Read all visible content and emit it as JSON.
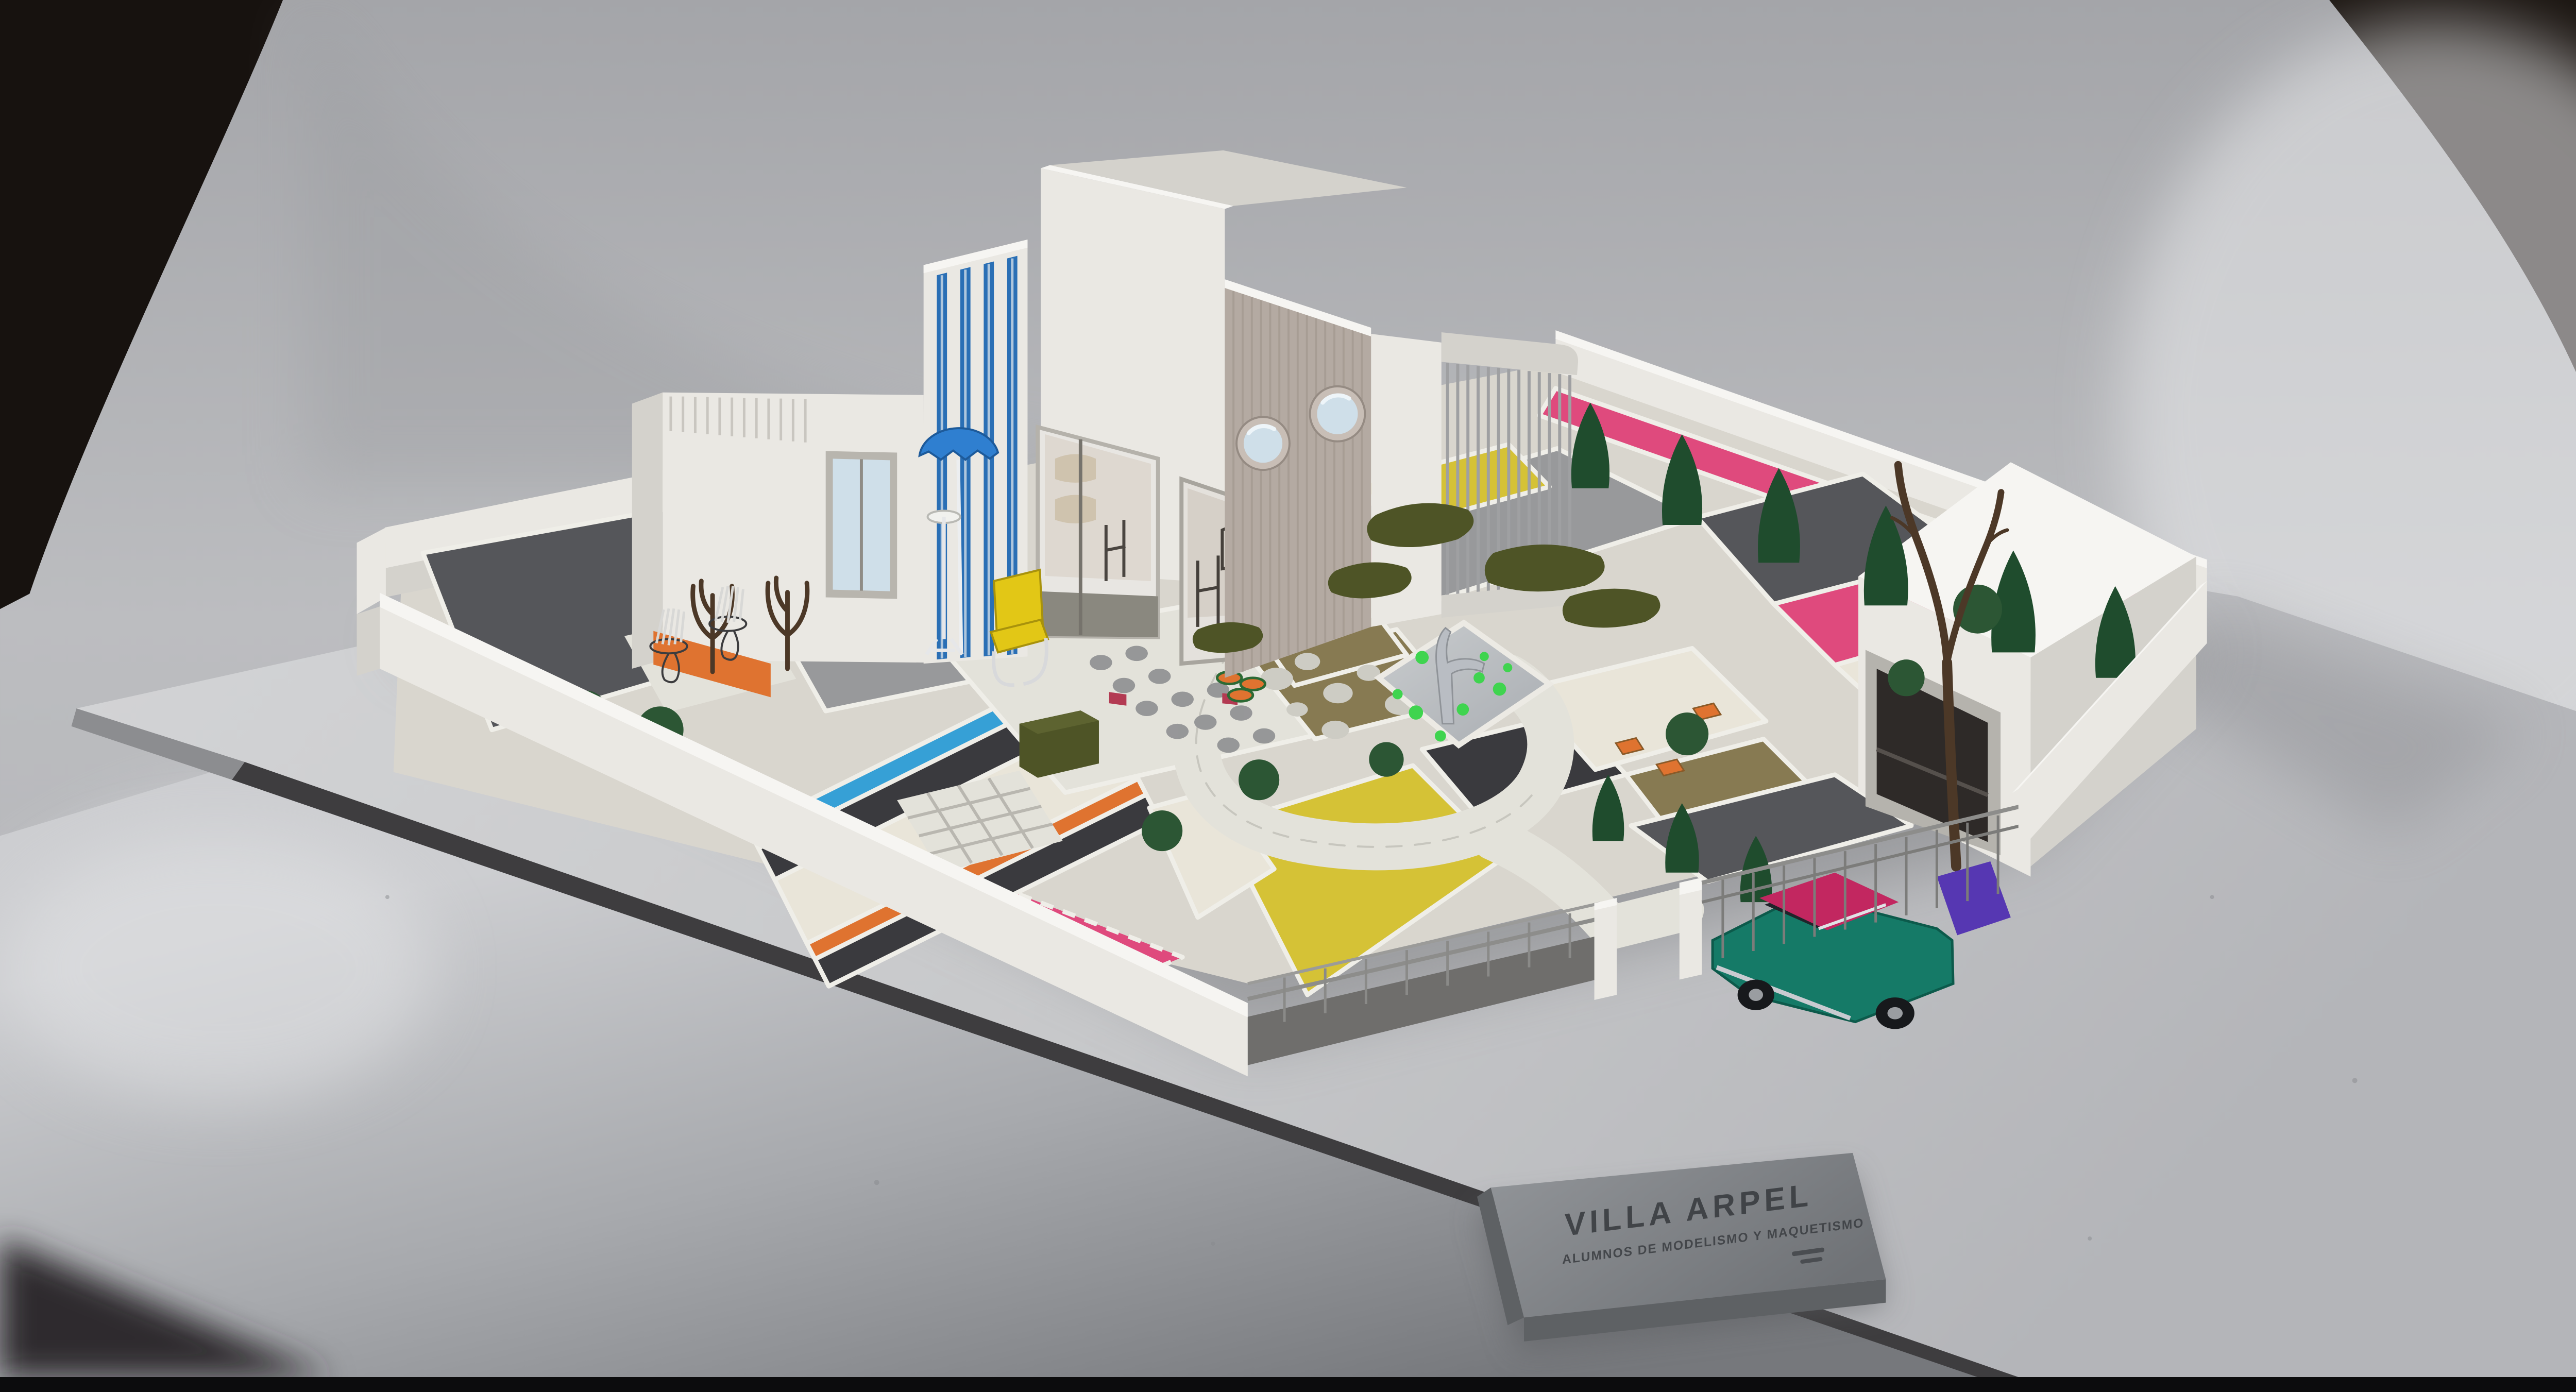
{
  "scene": {
    "type": "photograph",
    "subject": "Architectural scale model (maquette) of a modernist villa with geometric coloured-gravel garden, photographed on a grey studio sweep backdrop",
    "nameplate": {
      "title": "VILLA ARPEL",
      "subtitle": "ALUMNOS DE MODELISMO Y MAQUETISMO",
      "small_engraving_legible": false
    },
    "inventory": {
      "porthole_windows": 2,
      "blue_facade_stripes": 4,
      "cypress_cone_trees": 9,
      "round_pompom_bushes": 8,
      "wireframe_chairs": 2,
      "parasol": 1,
      "yellow_chair": 1,
      "pond_with_fish_fountain": 1,
      "vintage_car": 1,
      "garage": 1,
      "bare_tree": 1,
      "nameplate": 1
    },
    "palette": {
      "bg_grey": "#b3b4b8",
      "bg_light": "#d8d9db",
      "bg_dark": "#17120f",
      "board": "#c9cacc",
      "board_edge": "#3e3d3f",
      "table": "#9fa1a5",
      "wall_white": "#eae8e3",
      "wall_shade": "#d4d2cc",
      "wall_top": "#f6f5f2",
      "facade_taupe": "#b4aaa2",
      "glass": "#cfdfe9",
      "stripe_blue": "#2a6fb5",
      "umbrella_blue": "#2f7fd0",
      "accent_yellow": "#e2c716",
      "gravel_dark": "#55565a",
      "gravel_grey": "#98999b",
      "gravel_black": "#3a3a3e",
      "gravel_yellow": "#d5c236",
      "gravel_pink": "#df4a7d",
      "gravel_orange": "#df7330",
      "gravel_blue": "#36a0d6",
      "gravel_white": "#e9e5d9",
      "soil_olive": "#877a52",
      "path_white": "#e3e2da",
      "tree_green": "#1f4c2d",
      "moss_green": "#4e5426",
      "bush_green": "#2c5634",
      "trunk_brown": "#4c3827",
      "car_teal": "#157a67",
      "car_magenta": "#c22760",
      "car_purple": "#5637b2",
      "fish_silver": "#b9bdc3",
      "lily_green": "#3fd44f",
      "plate_grey": "#84878b",
      "plate_side": "#5e6164",
      "plate_text": "#3a3d41"
    }
  }
}
